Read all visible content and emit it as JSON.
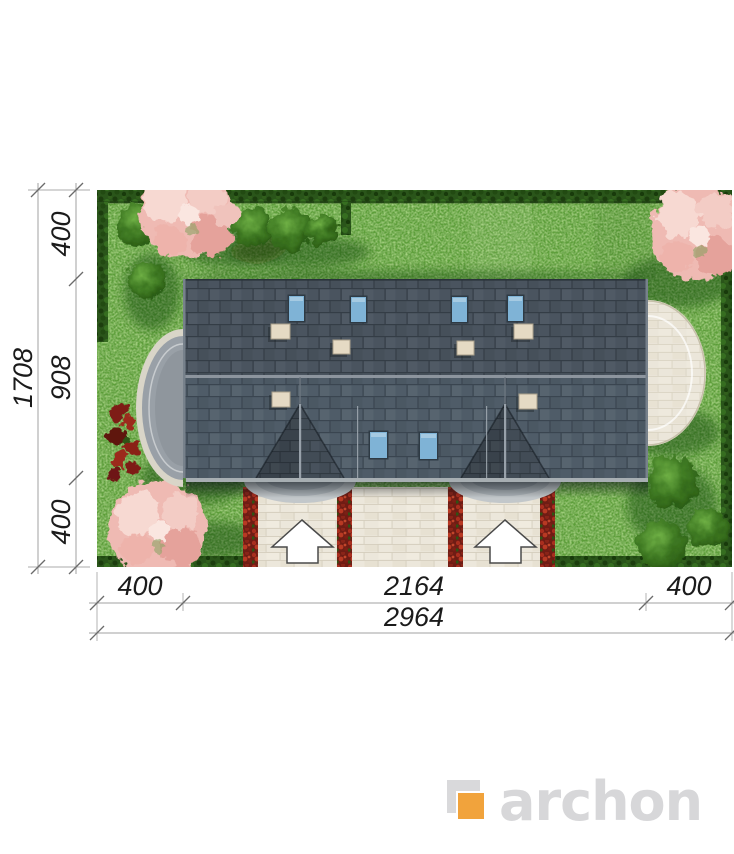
{
  "page": {
    "background": "#FFFFFF",
    "description": "Top-down site plan of a semi-detached house on a garden plot with dimension lines"
  },
  "dimensions": {
    "left": {
      "segment_top": "400",
      "segment_middle": "908",
      "segment_bottom": "400",
      "total": "1708"
    },
    "bottom": {
      "segment_left": "400",
      "segment_center": "2164",
      "segment_right": "400",
      "total": "2964"
    }
  },
  "plan": {
    "colors": {
      "grass": "#5C9E37",
      "hedge": "#2B571B",
      "roof_upper": "#4A545F",
      "roof_lower": "#4F5C68",
      "roof_window": "#7FB3D6",
      "chimney": "#E5DAC4",
      "pavement": "#ECE7DB",
      "flower_bed": "#8F2420",
      "blossom_tree": "#F2C4BF",
      "terrace_left": "#99A0A7",
      "dimension_lines": "#A0A0A0",
      "dimension_text": "#1B1B1B"
    },
    "features": {
      "roof_windows_back": 4,
      "roof_windows_front": 2,
      "chimneys": 6,
      "entrance_arrows": 2,
      "blossom_trees": 3
    }
  },
  "logo": {
    "text": "archon",
    "mark_gray": "#D9D9DB",
    "mark_orange": "#F1A33C",
    "text_color": "#D7D7D9"
  }
}
